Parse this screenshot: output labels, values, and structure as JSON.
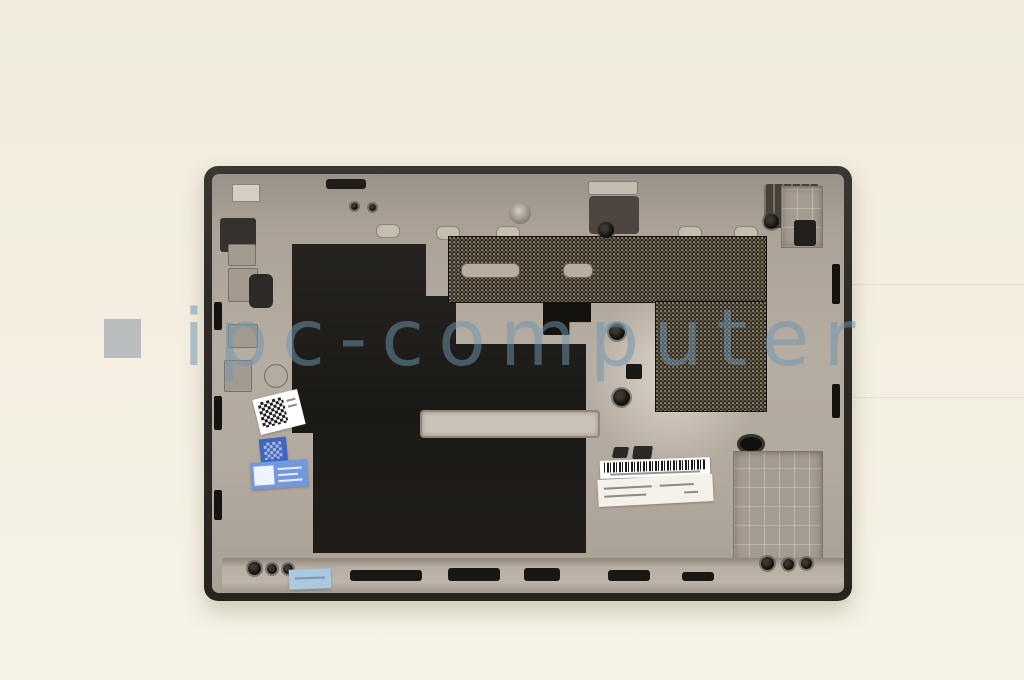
{
  "scene": {
    "description": "Product photo of a laptop base cover (bottom case) shown interior side up on a cream backdrop",
    "background_color": "#f3eee0"
  },
  "watermark": {
    "square_bullet": "",
    "text": "ipc-computer"
  },
  "part": {
    "name": "laptop-base-cover",
    "rim_color": "#2e2b28",
    "surface_color": "#b2a99f",
    "insulation_sheet_color": "#201d19",
    "vent_mesh_color": "#241f17"
  },
  "stickers": {
    "barcode_strip": {
      "kind": "barcode",
      "color": "#ffffff"
    },
    "part_label": {
      "kind": "printed-label",
      "color": "#f4f1ea",
      "text_rows": 2
    },
    "qr_sticker_white": {
      "kind": "qr-code",
      "color": "#ffffff"
    },
    "qr_sticker_blue_small": {
      "kind": "qr-code",
      "color": "#3d66c4"
    },
    "qr_label_blue": {
      "kind": "qr-label",
      "color": "#7199dc"
    },
    "bottom_edge_sticker": {
      "kind": "label",
      "color": "#a9c8e2"
    }
  },
  "colors": {
    "bg": "#f3eee0",
    "rim": "#2e2b28",
    "surface": "#b2a99f",
    "mylar": "#201d19",
    "mesh": "#241f17",
    "wm-text": "rgba(110,150,175,0.52)",
    "wm-square": "rgba(168,174,178,0.78)",
    "sticker-blue": "#3d66c4",
    "sticker-lightblue": "#7199dc",
    "sticker-paleblue": "#a9c8e2"
  }
}
